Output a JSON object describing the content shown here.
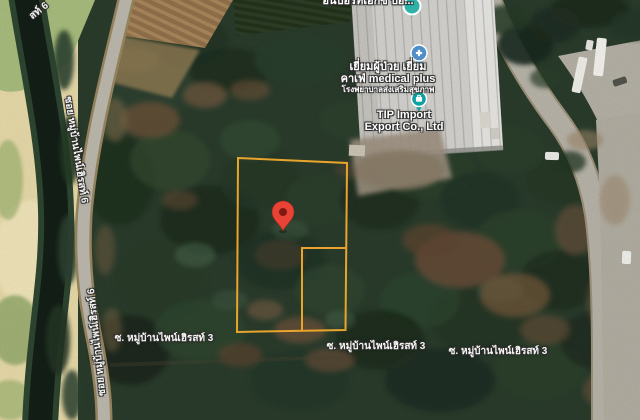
{
  "map": {
    "pois": {
      "import_partial": {
        "label": "อินปอร์ทเอ็กซ์ ป้อ..."
      },
      "medical_cafe": {
        "line1": "เยี่ยมผู้ป่วย เยี่ยม",
        "line2": "คาเฟ่ medical plus",
        "line3": "โรงพยาบาลส่งเสริมสุขภาพ"
      },
      "tip_import": {
        "line1": "TIP Import",
        "line2": "Export Co., Ltd"
      }
    },
    "roads": {
      "soi3": "ซ. หมู่บ้านไพน์เฮิรสท์ 3",
      "soi6": "ซอย หมู่บ้านไพน์เฮิรสท์ 6",
      "soi6_fragment": "สท์ 6"
    },
    "colors": {
      "boundary": "#E9A52B",
      "red_pin": "#E94335",
      "medical_pin": "#4E8FC7",
      "tip_pin": "#0CA1A0",
      "top_pin": "#2FB3A9"
    }
  }
}
